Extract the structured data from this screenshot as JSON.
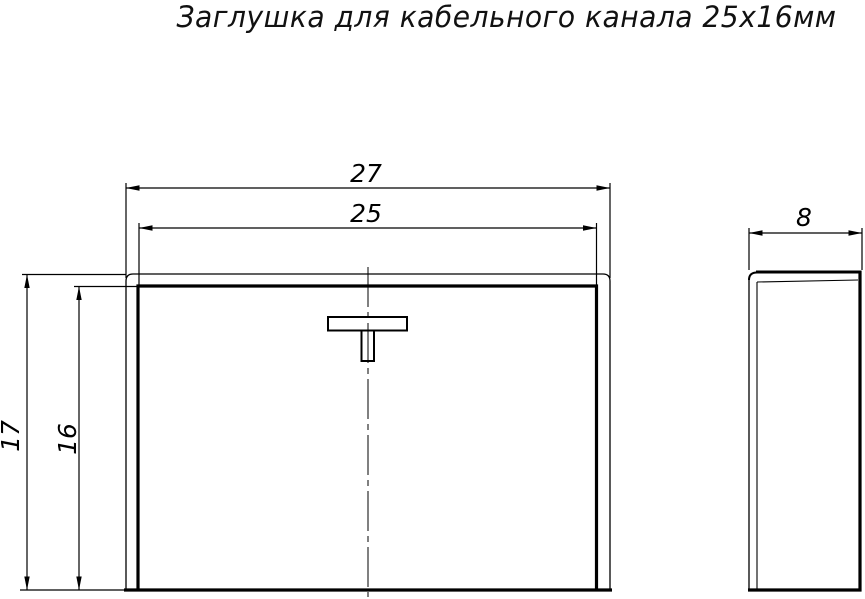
{
  "title": "Заглушка для кабельного канала 25х16мм",
  "dimensions": {
    "outer_width": "27",
    "inner_width": "25",
    "outer_height": "17",
    "inner_height": "16",
    "depth": "8"
  },
  "colors": {
    "line": "#000000",
    "text": "#111111",
    "background": "#ffffff"
  }
}
